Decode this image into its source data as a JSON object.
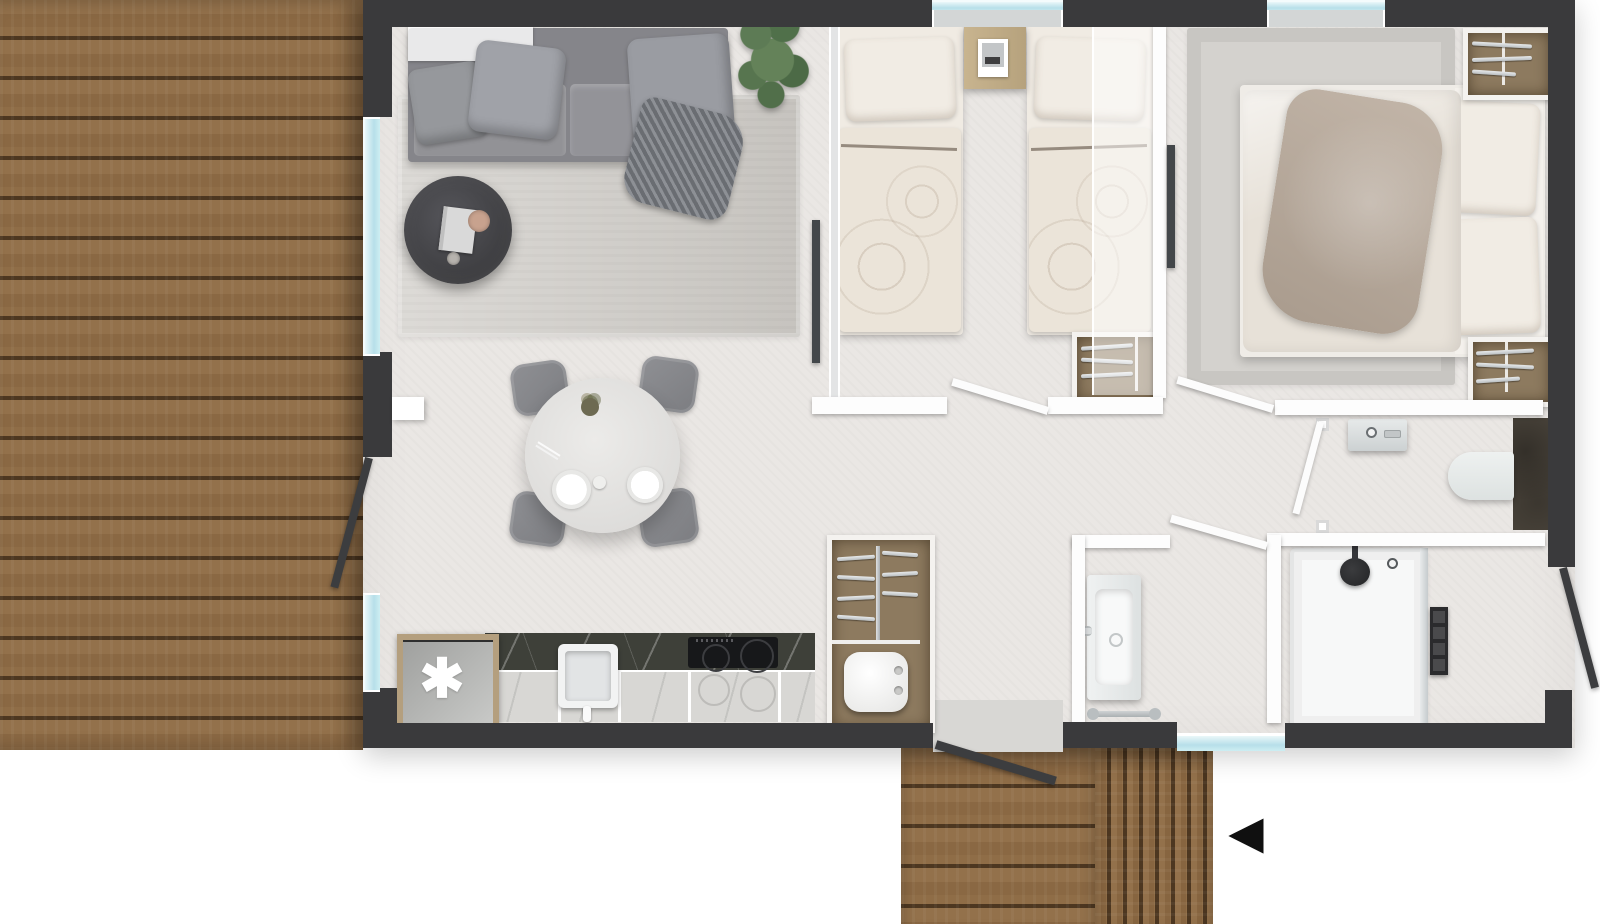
{
  "scene": {
    "kind": "architectural floor plan, top-down 3D render",
    "canvas": {
      "width": 1600,
      "height": 924
    },
    "text_on_image": "none (glyph symbols only)"
  },
  "symbols": {
    "heater_asterisk": "✱",
    "direction_arrow": "◀"
  },
  "palette": {
    "background": "#ffffff",
    "exterior_wall": "#3a3a3c",
    "interior_floor": "#eae7e4",
    "deck_wood": "#8a6843",
    "deck_gap": "#241609",
    "window_glass": "#b7dfe9",
    "partition_white": "#fdfdfd",
    "rug": "#d1cec9",
    "sofa_gray": "#8b8b8f",
    "bed_linen": "#ebe4d9",
    "throw_taupe": "#b5a79a",
    "closet_wood": "#8d7a5f",
    "nightstand_wood": "#c2ad8a",
    "counter_marble": "#3e4039",
    "cooktop_black": "#17181a",
    "fixture_white": "#eceeee",
    "tile_dark": "#4a443b",
    "radiator_black": "#2b2b2d",
    "plant_green": "#5d7b55",
    "arrow_black": "#101010"
  },
  "rooms": [
    {
      "id": "terrace-left",
      "contents": [
        "horizontal wood decking",
        "sliding glass wall",
        "open patio door"
      ]
    },
    {
      "id": "living-room",
      "contents": [
        "two-seat gray sofa",
        "four gray cushions",
        "striped throw blanket",
        "white console shelf",
        "potted plant",
        "round dark coffee table with book, dish and cup",
        "large light rug"
      ]
    },
    {
      "id": "dining-area",
      "contents": [
        "round white table",
        "4 gray chairs",
        "2 plates",
        "flower vase",
        "small cup"
      ]
    },
    {
      "id": "kitchen",
      "contents": [
        "dark marble counter",
        "square sink with faucet",
        "black induction cooktop",
        "appliance cabinet with asterisk symbol"
      ]
    },
    {
      "id": "utility-closet",
      "contents": [
        "hanging rails",
        "white water heater with two knobs"
      ]
    },
    {
      "id": "bedroom-twin",
      "contents": [
        "two single beds with patterned duvets",
        "wooden nightstand with picture frame",
        "window",
        "built-in wardrobe with rails",
        "frosted sliding panel"
      ]
    },
    {
      "id": "bedroom-double",
      "contents": [
        "double bed with white duvet and taupe throw",
        "two pillows",
        "large rug",
        "two built-in wardrobes with rails",
        "window"
      ]
    },
    {
      "id": "wc",
      "contents": [
        "washbasin with faucet and soap",
        "wall-hung toilet",
        "dark tiled wall",
        "glass pivot door"
      ]
    },
    {
      "id": "bathroom",
      "contents": [
        "vanity basin with faucet",
        "towel rail",
        "hinged door"
      ]
    },
    {
      "id": "shower-room",
      "contents": [
        "walk-in shower tray",
        "ceiling shower head",
        "mixer knob",
        "black towel radiator",
        "glass screen",
        "window"
      ]
    },
    {
      "id": "hallway",
      "contents": [
        "three white interior doors shown open"
      ]
    },
    {
      "id": "terrace-bottom",
      "contents": [
        "horizontal decking section",
        "vertical decking section",
        "open entry door",
        "direction arrow glyph"
      ]
    }
  ]
}
